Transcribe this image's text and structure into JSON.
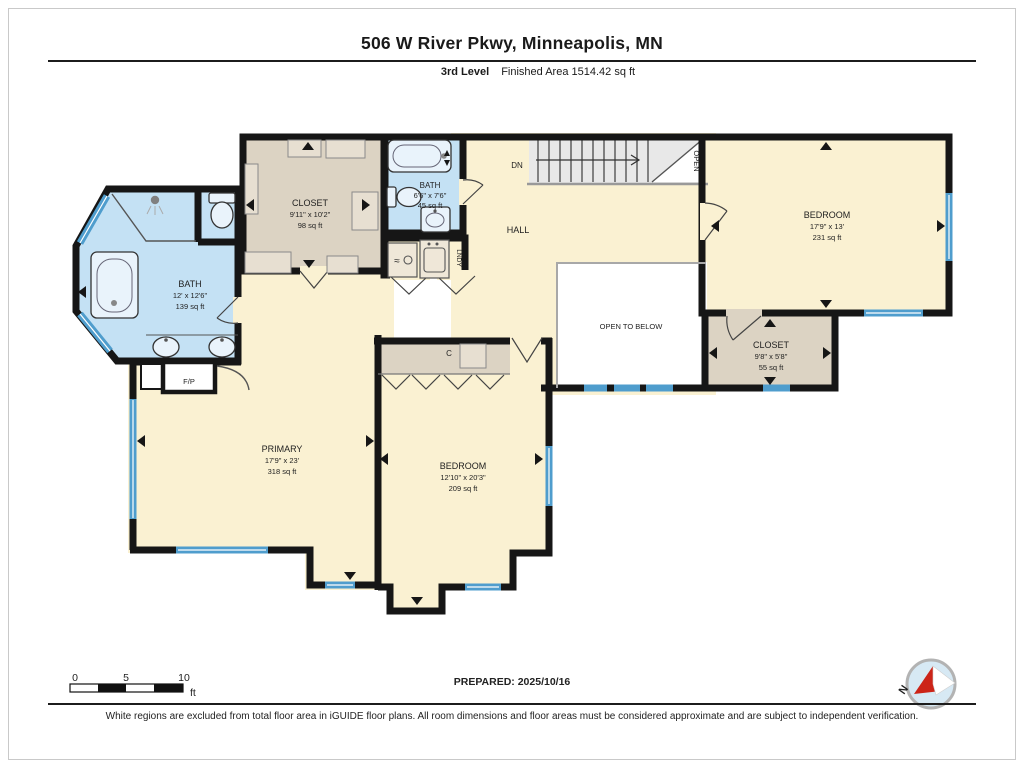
{
  "page": {
    "title": "506 W River Pkwy, Minneapolis, MN",
    "level_label": "3rd Level",
    "area_label": "Finished Area 1514.42 sq ft",
    "prepared_label": "PREPARED: 2025/10/16",
    "disclaimer": "White regions are excluded from total floor area in iGUIDE floor plans. All room dimensions and floor areas must be considered approximate and are subject to independent verification.",
    "scale_bar": {
      "tick0": "0",
      "tick5": "5",
      "tick10": "10",
      "unit": "ft"
    },
    "compass": {
      "north_label": "N"
    }
  },
  "rooms": {
    "bath_main": {
      "name": "BATH",
      "dims": "12' x 12'6\"",
      "area": "139 sq ft"
    },
    "closet_top": {
      "name": "CLOSET",
      "dims": "9'11\" x 10'2\"",
      "area": "98 sq ft"
    },
    "bath_small": {
      "name": "BATH",
      "dims": "6'6\" x 7'6\"",
      "area": "45 sq ft"
    },
    "hall": {
      "name": "HALL"
    },
    "laundry": {
      "name": "LNDY"
    },
    "stairs": {
      "down_label": "DN",
      "open_label": "OPEN"
    },
    "bedroom_right": {
      "name": "BEDROOM",
      "dims": "17'9\" x 13'",
      "area": "231 sq ft"
    },
    "closet_right": {
      "name": "CLOSET",
      "dims": "9'8\" x 5'8\"",
      "area": "55 sq ft"
    },
    "open_below": {
      "name": "OPEN TO BELOW"
    },
    "primary": {
      "name": "PRIMARY",
      "dims": "17'9\" x 23'",
      "area": "318 sq ft"
    },
    "bedroom_bottom": {
      "name": "BEDROOM",
      "dims": "12'10\" x 20'3\"",
      "area": "209 sq ft"
    },
    "fireplace": {
      "name": "F/P"
    },
    "closet_c": {
      "name": "C"
    }
  },
  "colors": {
    "wall": "#161616",
    "floor": "#faf1d2",
    "bath": "#c4e1f4",
    "closet": "#dcd3c3",
    "window": "#4f9dcd",
    "stairs": "#e8e8e8",
    "compass_red": "#cc2418"
  }
}
